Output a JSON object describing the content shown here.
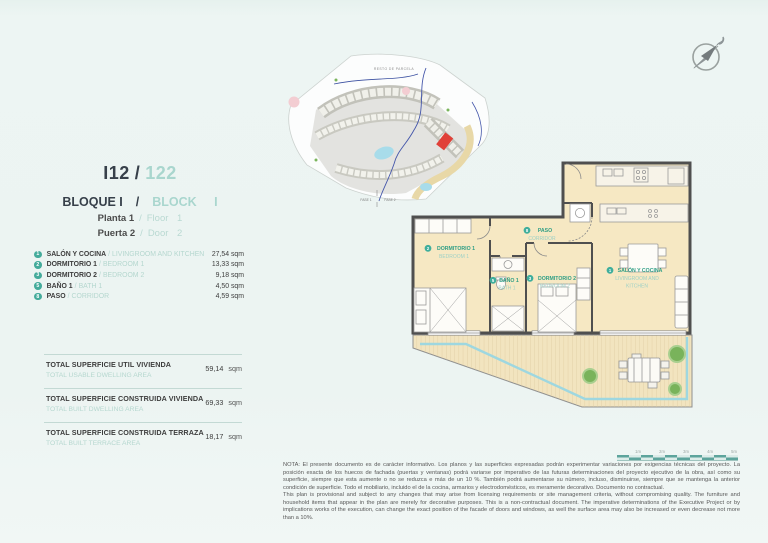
{
  "sep": "/",
  "unit": {
    "code": "I12",
    "code_alt": "122",
    "block_es": "BLOQUE I",
    "block_en": "BLOCK I",
    "floor_es": "Planta 1",
    "floor_en": "Floor 1",
    "door_es": "Puerta 2",
    "door_en": "Door 2"
  },
  "rooms": [
    {
      "num": "1",
      "es": "SALÓN Y COCINA",
      "en": "LIVINGROOM AND KITCHEN",
      "area": "27,54 sqm"
    },
    {
      "num": "2",
      "es": "DORMITORIO 1",
      "en": "BEDROOM 1",
      "area": "13,33 sqm"
    },
    {
      "num": "3",
      "es": "DORMITORIO 2",
      "en": "BEDROOM 2",
      "area": "9,18 sqm"
    },
    {
      "num": "5",
      "es": "BAÑO 1",
      "en": "BATH 1",
      "area": "4,50 sqm"
    },
    {
      "num": "8",
      "es": "PASO",
      "en": "CORRIDOR",
      "area": "4,59 sqm"
    }
  ],
  "totals": [
    {
      "es": "TOTAL SUPERFICIE UTIL VIVIENDA",
      "en": "TOTAL USABLE DWELLING AREA",
      "value": "59,14",
      "unit": "sqm"
    },
    {
      "es": "TOTAL SUPERFICIE CONSTRUIDA VIVIENDA",
      "en": "TOTAL BUILT DWELLING AREA",
      "value": "69,33",
      "unit": "sqm"
    },
    {
      "es": "TOTAL SUPERFICIE CONSTRUIDA TERRAZA",
      "en": "TOTAL BUILT TERRACE AREA",
      "value": "18,17",
      "unit": "sqm"
    }
  ],
  "site_plan": {
    "area_label": "RESTO DE PARCELA",
    "fase1": "FASE 1",
    "fase2": "FASE 2"
  },
  "plan_labels": {
    "bedroom1": {
      "num": "2",
      "es": "DORMITORIO 1",
      "en": "BEDROOM 1"
    },
    "paso": {
      "num": "8",
      "es": "PASO",
      "en": "CORRIDOR"
    },
    "bath1": {
      "num": "5",
      "es": "BAÑO 1",
      "en": "BATH 1"
    },
    "bedroom2": {
      "num": "3",
      "es": "DORMITORIO 2",
      "en": "BEDROOM 2"
    },
    "salon": {
      "num": "1",
      "es": "SALÓN Y COCINA",
      "en_line1": "LIVINGROOM AND",
      "en_line2": "KITCHEN"
    }
  },
  "scale_bar": {
    "labels": [
      "1m",
      "2m",
      "3m",
      "4m",
      "5m"
    ]
  },
  "disclaimer": {
    "es": "NOTA: El presente documento es de carácter informativo. Los planos y las superficies expresadas podrán experimentar variaciones por exigencias técnicas del proyecto. La posición exacta de los huecos de fachada (puertas y ventanas) podrá variarse por imperativo de las futuras determinaciones del proyecto ejecutivo de la obra, así como su superficie, siempre que esta aumente o no se reduzca e más de un 10 %. También podrá aumentarse su número, incluso, disminuirse, siempre que se mantenga la anterior condición de superficie. Todo el mobiliario, incluido el de la cocina, armarios y electrodomésticos, es meramente decorativo. Documento no contractual.",
    "en": "This plan is provisional and subject to any changes that may arise from licensing requirements or site management criteria, without compromising quality. The furniture and household items that appear in the plan are merely for decorative purposes. This is a non-contractual document. The imperative determinations of the Executive Project or by implications works of the execution, can change the exact position of the facade of doors and windows, as well the surface area may also be increased or even decrease not more than a 10%."
  },
  "icons": {
    "compass": "north-arrow-compass"
  },
  "colors": {
    "accent_teal_light": "#a9d6ce",
    "badge_teal": "#44ab9b",
    "plan_label_teal": "#2f9e85",
    "plan_label_teal_light": "#9ed1c6",
    "room_fill": "#f6e8c3",
    "wall": "#4f4f4f",
    "terrace_glass": "#9ed7e0",
    "highlight_red": "#e04038"
  }
}
